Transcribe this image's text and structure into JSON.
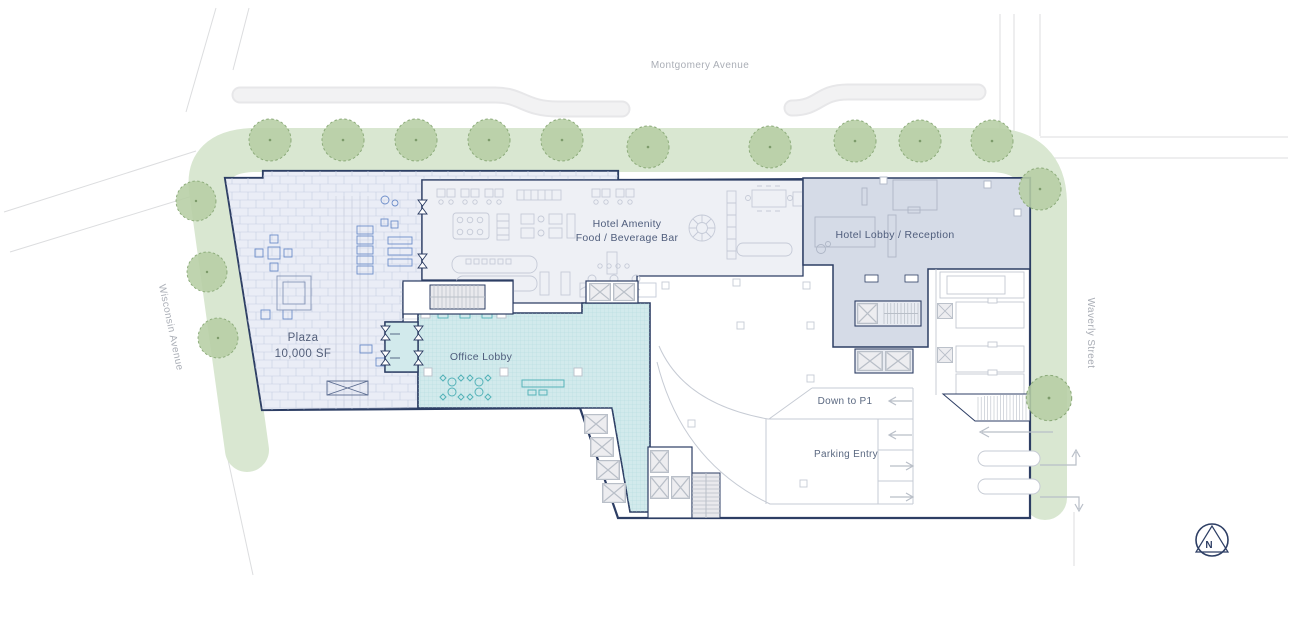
{
  "plan": {
    "type": "architectural-site-plan",
    "floor": "ground"
  },
  "streets": {
    "top": "Montgomery Avenue",
    "left": "Wisconsin Avenue",
    "right": "Waverly Street"
  },
  "areas": {
    "plaza": {
      "name": "Plaza",
      "size": "10,000 SF"
    },
    "hotel_amenity": {
      "line1": "Hotel Amenity",
      "line2": "Food / Beverage Bar"
    },
    "hotel_lobby": {
      "label": "Hotel Lobby / Reception"
    },
    "office_lobby": {
      "label": "Office Lobby"
    },
    "parking": {
      "down_to_p1": "Down to P1",
      "entry": "Parking Entry"
    }
  },
  "compass": {
    "north": "N"
  },
  "colors": {
    "outline_navy": "#2d3e64",
    "plaza_fill": "#eaedf6",
    "plaza_hatch": "#c5cde1",
    "plaza_furniture_blue": "#6d8dc9",
    "office_teal_fill": "#d2eaec",
    "office_teal_grid": "#aed9dc",
    "office_furniture_teal": "#54b2b8",
    "amenity_fill": "#eef0f5",
    "hotel_lobby_fill": "#d5dbe7",
    "furniture_gray": "#c5cad7",
    "green_band": "#d9e7d1",
    "tree_fill": "#b6cea4",
    "tree_stroke": "#8cab7a",
    "street_line": "#dcdddf",
    "sidewalk": "#efeff1",
    "lane_line": "#c6cbd4",
    "arrow_gray": "#b9bfc8",
    "area_label": "#4f5d7c",
    "street_label": "#aaaeb6"
  }
}
